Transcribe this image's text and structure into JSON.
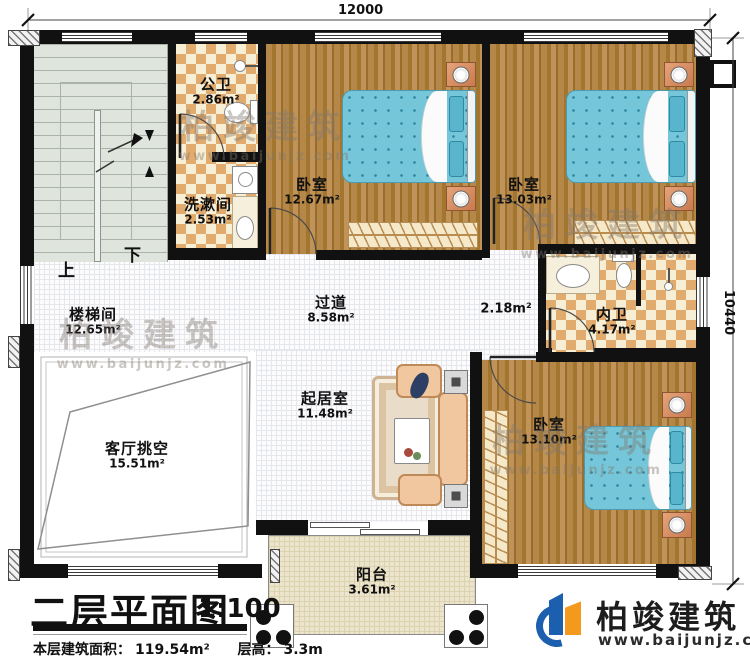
{
  "title": {
    "text": "二层平面图",
    "scale": "1:100"
  },
  "info": {
    "area_label": "本层建筑面积：",
    "area_value": "119.54m²",
    "height_label": "层高：",
    "height_value": "3.3m"
  },
  "dimensions": {
    "width": "12000",
    "height": "10440"
  },
  "stairs": {
    "up": "上",
    "down": "下"
  },
  "rooms": [
    {
      "name": "楼梯间",
      "area": "12.65m²"
    },
    {
      "name": "公卫",
      "area": "2.86m²"
    },
    {
      "name": "洗漱间",
      "area": "2.53m²"
    },
    {
      "name": "卧室",
      "area": "12.67m²"
    },
    {
      "name": "卧室",
      "area": "13.03m²"
    },
    {
      "name": "过道",
      "area": "8.58m²"
    },
    {
      "name": "",
      "area": "2.18m²"
    },
    {
      "name": "内卫",
      "area": "4.17m²"
    },
    {
      "name": "卧室",
      "area": "13.10m²"
    },
    {
      "name": "起居室",
      "area": "11.48m²"
    },
    {
      "name": "客厅挑空",
      "area": "15.51m²"
    },
    {
      "name": "阳台",
      "area": "3.61m²"
    }
  ],
  "brand": {
    "name": "柏竣建筑",
    "url": "www.baijunjz.com"
  },
  "watermark": {
    "name": "柏竣建筑",
    "url": "www.baijunjz.com"
  }
}
